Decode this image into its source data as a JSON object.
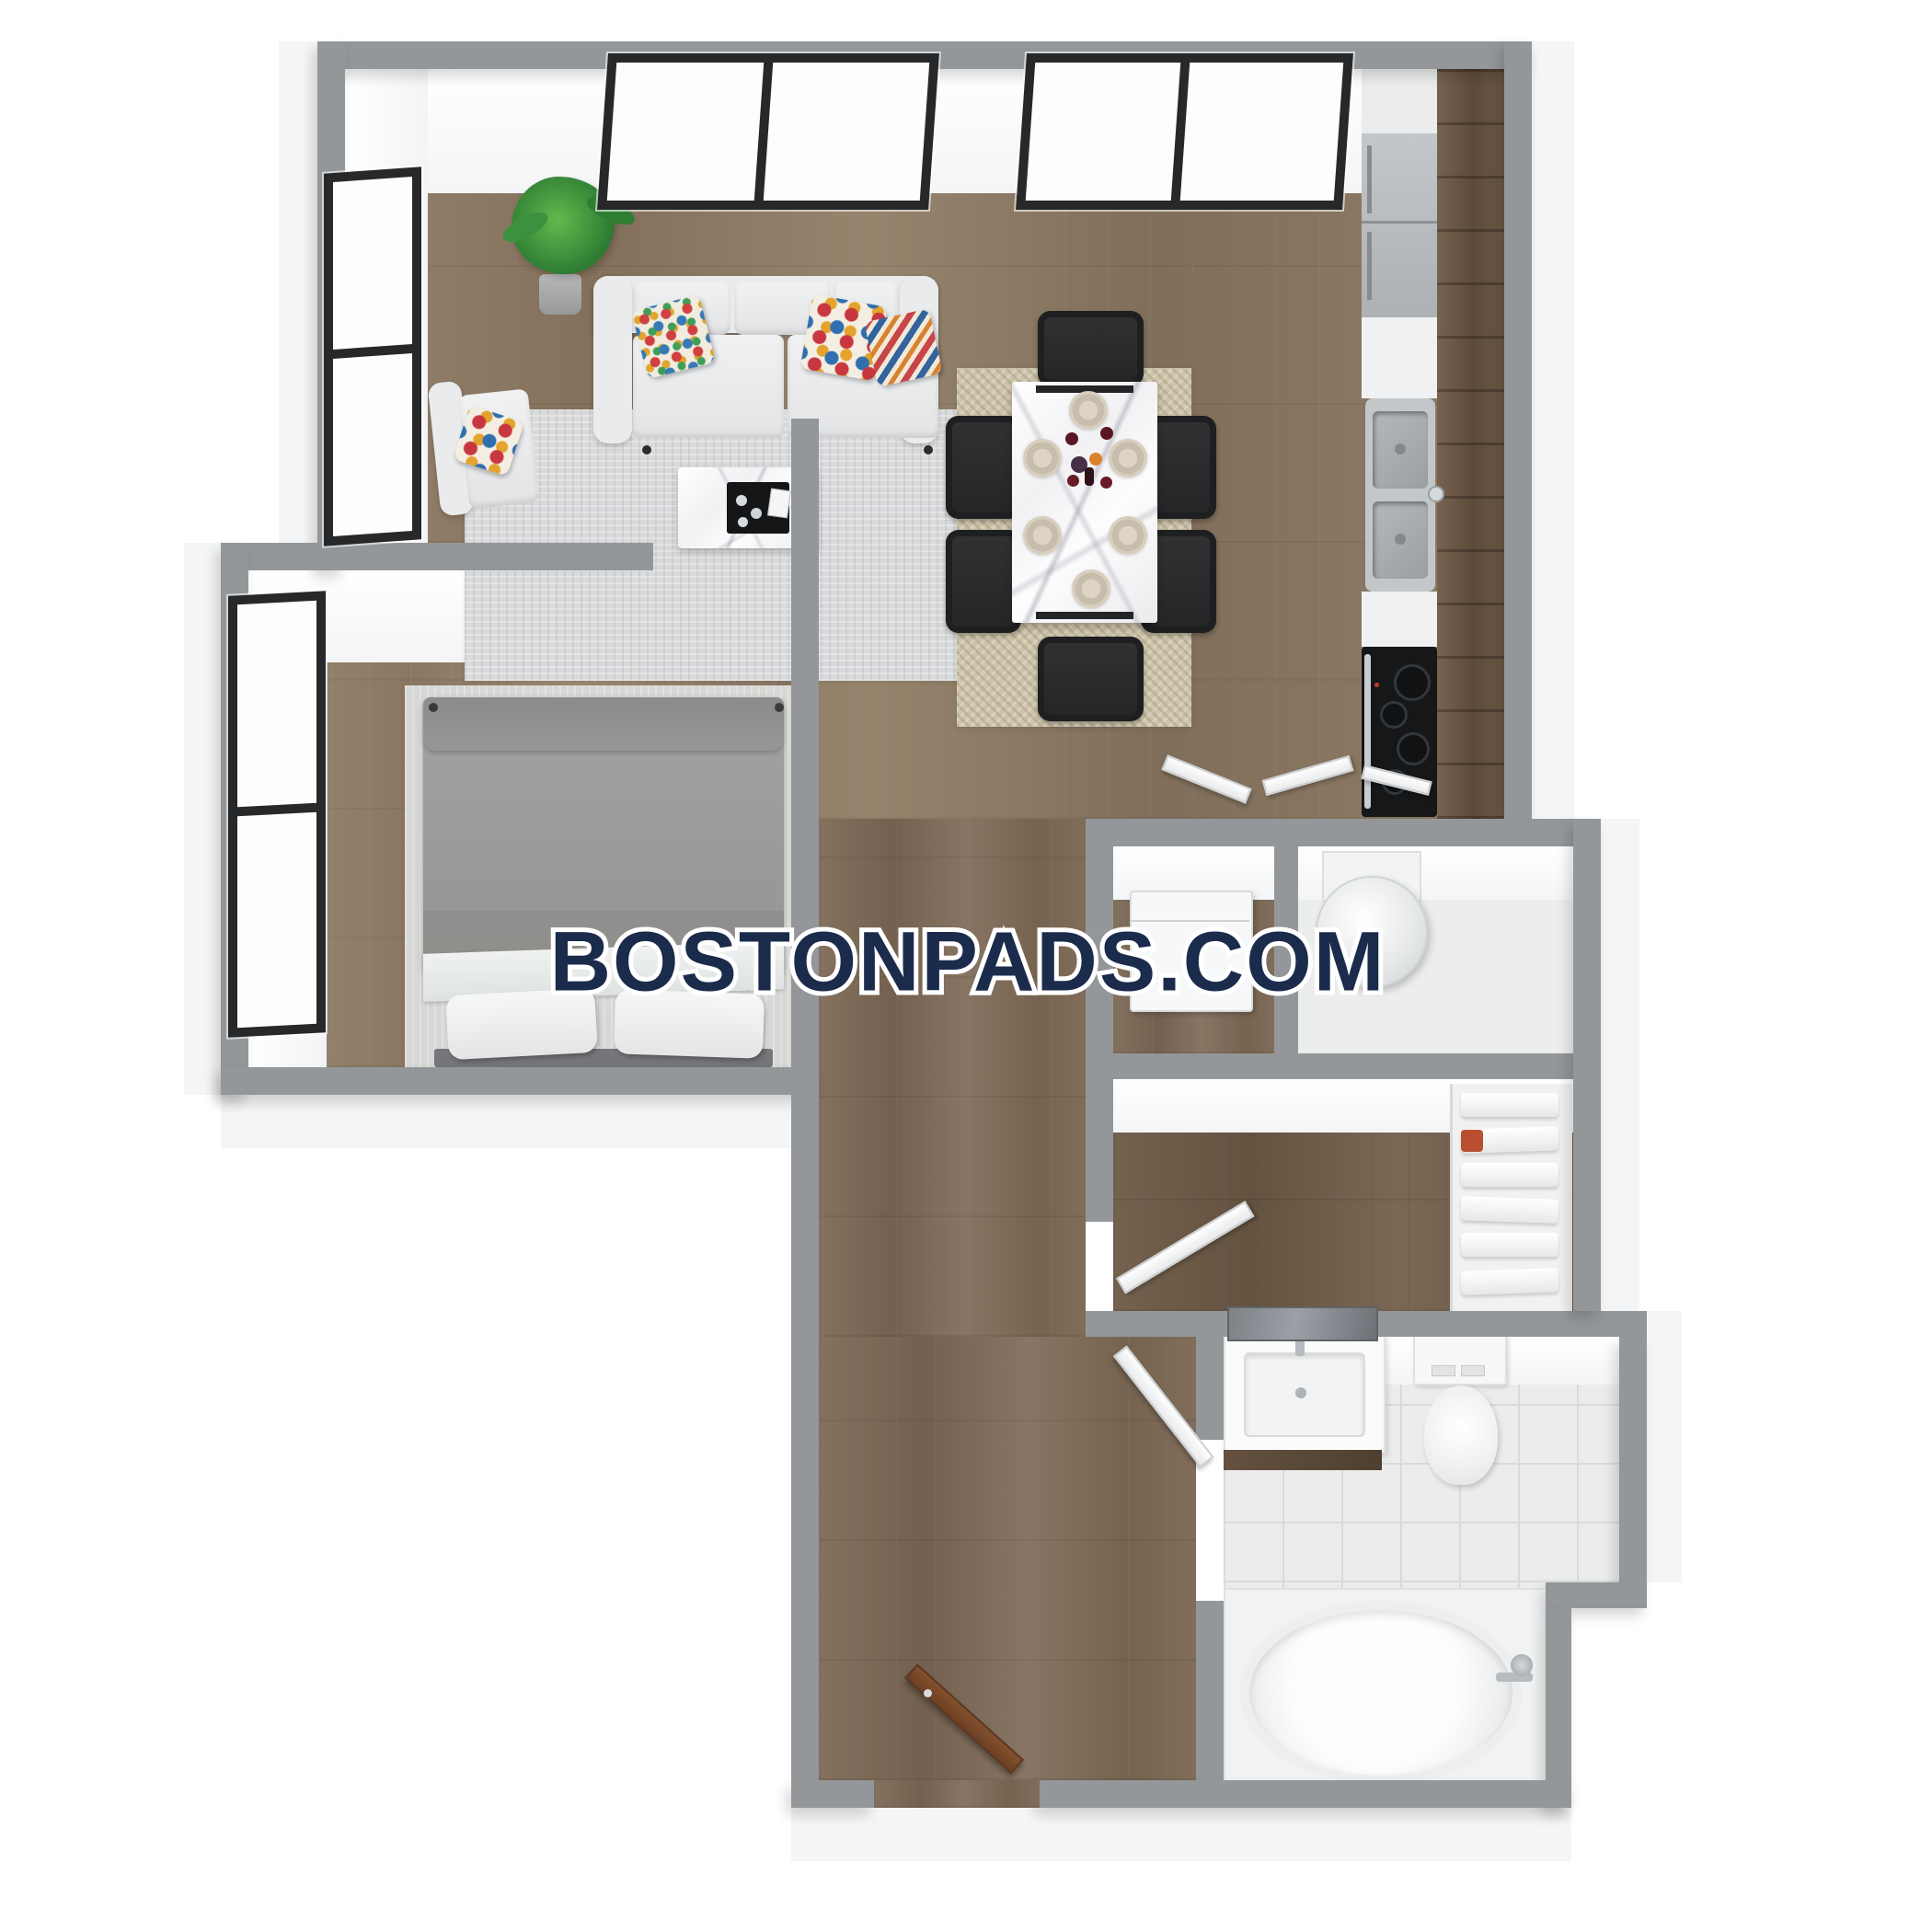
{
  "watermark": {
    "text": "BOSTONPADS.COM",
    "text_color": "#1b2b4c",
    "outline_color": "#ffffff"
  },
  "palette": {
    "background": "#ffffff",
    "wall_gray": "#949799",
    "wall_face_white": "#f4f5f6",
    "floor_wood_main": "#8f7c66",
    "floor_wood_bedroom": "#97856f",
    "floor_wood_hall": "#7f6d5a",
    "floor_wood_closet": "#6f5d4b",
    "kitchen_cabinet_wood": "#6b5646",
    "appliance_steel": "#b9bdc1",
    "stove_black": "#151719",
    "rug_living_gray": "#d9dadc",
    "rug_dining_jute": "#cec4a9",
    "rug_bedroom": "#d7d7d5",
    "bath_tile": "#ebecec",
    "vanity_wood": "#5c4a3b",
    "entry_door_brown": "#7b4a2e",
    "window_frame_black": "#26282a",
    "bedding_gray": "#9b9b99",
    "chair_black": "#232527"
  },
  "scene": {
    "type": "3d-rendered-floor-plan",
    "unit_style": "one-bedroom apartment, top-down 3D view",
    "rooms": [
      {
        "name": "living-room",
        "items": [
          "sofa",
          "accent-pillows",
          "armchair",
          "coffee-table",
          "area-rug",
          "potted-plant",
          "windows"
        ]
      },
      {
        "name": "dining-area",
        "items": [
          "marble-dining-table",
          "six-black-chairs",
          "place-settings",
          "wine-glasses",
          "jute-rug"
        ]
      },
      {
        "name": "kitchen",
        "items": [
          "upper-cabinet",
          "refrigerator",
          "counter",
          "double-basin-sink",
          "cooktop-with-oven",
          "wood-cabinet-run"
        ]
      },
      {
        "name": "bedroom",
        "items": [
          "bed-gray-duvet",
          "two-white-pillows",
          "area-rug",
          "windows"
        ]
      },
      {
        "name": "utility-closets",
        "items": [
          "washer-unit",
          "water-heater-cylinder",
          "bifold-doors"
        ]
      },
      {
        "name": "walk-in-closet",
        "items": [
          "linen-shelving",
          "towel-stacks",
          "closet-door"
        ]
      },
      {
        "name": "bathroom",
        "items": [
          "vanity-sink",
          "mirror",
          "toilet",
          "soaking-tub",
          "tile-floor",
          "door"
        ]
      },
      {
        "name": "hallway-entry",
        "items": [
          "wood-floor",
          "entry-door-brown",
          "interior-door"
        ]
      }
    ],
    "window_groups": {
      "top_wall": 2,
      "living_left_wall": 1,
      "bedroom_left_wall": 1
    }
  }
}
